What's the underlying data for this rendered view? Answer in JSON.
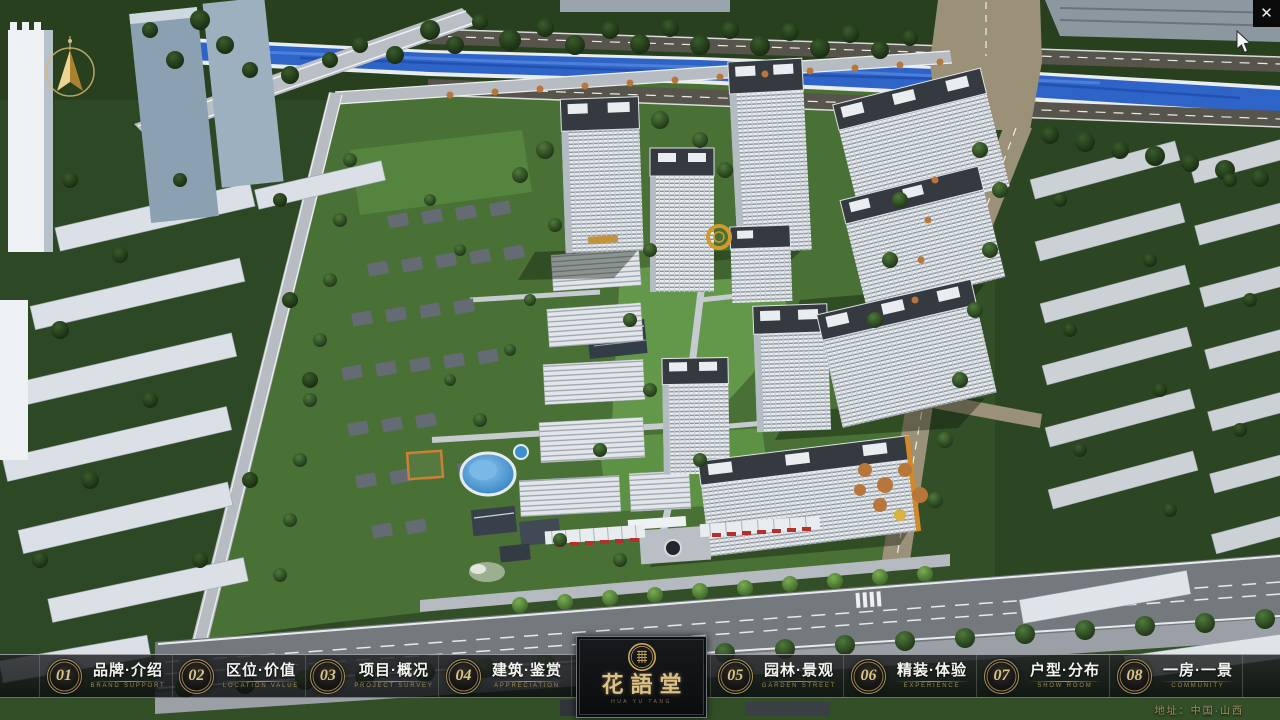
{
  "window": {
    "close_icon": "✕"
  },
  "logo": {
    "title": "花語堂",
    "tagline": "HUA YU TANG"
  },
  "nav": {
    "items": [
      {
        "num": "01",
        "label": "品牌·介绍",
        "sub": "BRAND SUPPORT"
      },
      {
        "num": "02",
        "label": "区位·价值",
        "sub": "LOCATION VALUE"
      },
      {
        "num": "03",
        "label": "项目·概况",
        "sub": "PROJECT SURVEY"
      },
      {
        "num": "04",
        "label": "建筑·鉴赏",
        "sub": "APPRECIATION"
      },
      {
        "num": "05",
        "label": "园林·景观",
        "sub": "GARDEN STREET"
      },
      {
        "num": "06",
        "label": "精装·体验",
        "sub": "EXPERIENCE"
      },
      {
        "num": "07",
        "label": "户型·分布",
        "sub": "SHOW ROOM"
      },
      {
        "num": "08",
        "label": "一房·一景",
        "sub": "COMMUNITY"
      }
    ]
  },
  "footer": {
    "address": "地址：中国·山西"
  },
  "colors": {
    "accent_gold": "#c9a85c",
    "bar_bg": "#121416",
    "river_blue": "#2e63c8",
    "label_white": "#f4f4f1",
    "sub_gold": "#9c8953"
  }
}
